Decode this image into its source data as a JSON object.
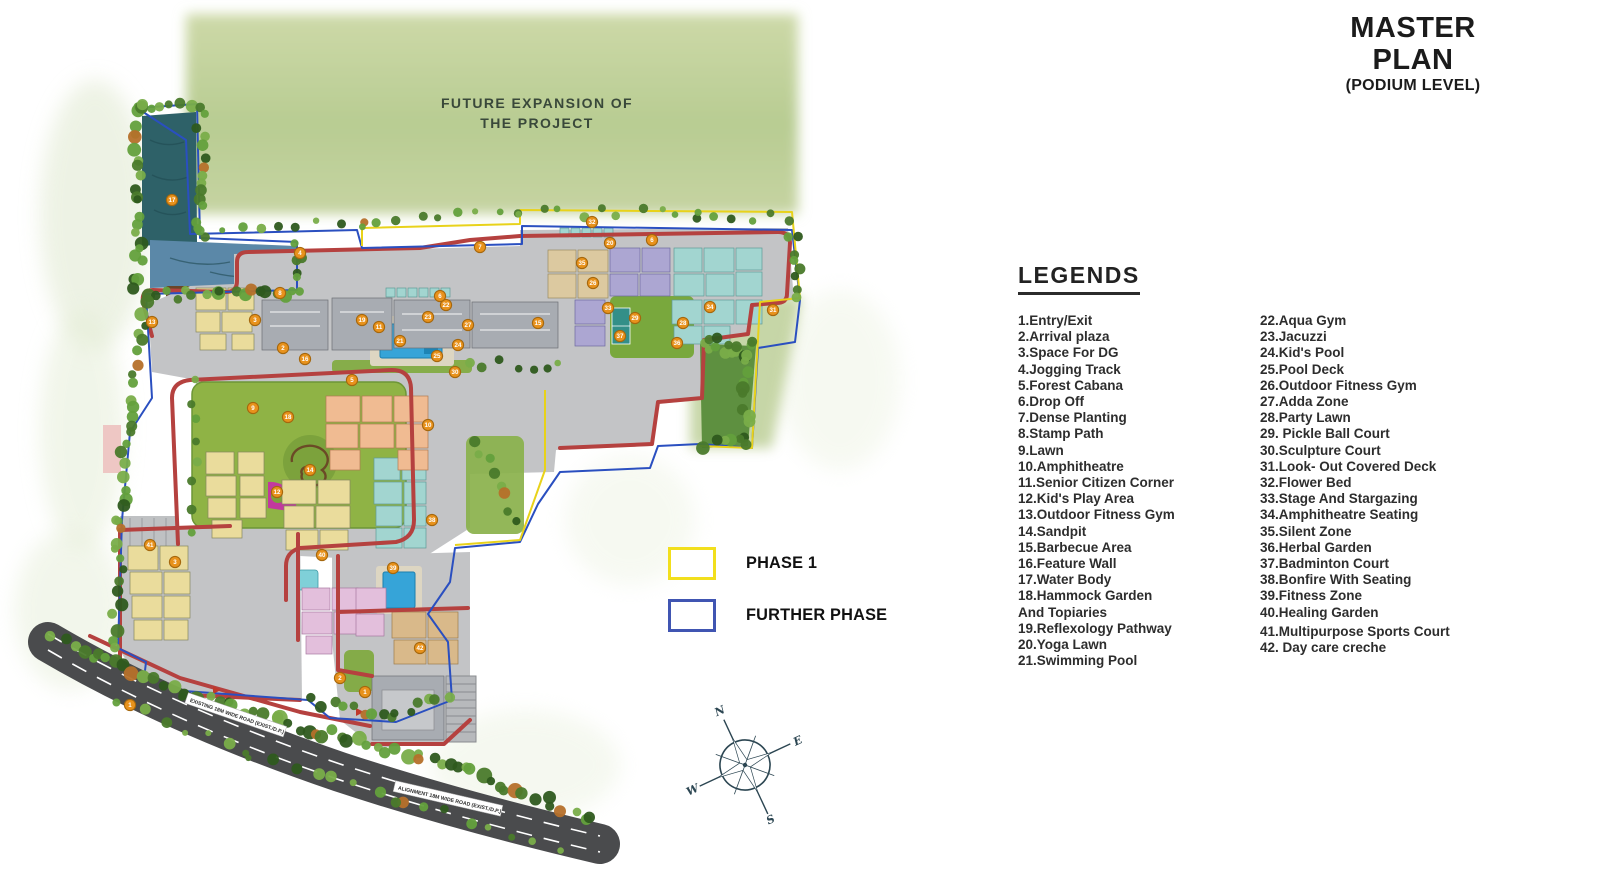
{
  "title": {
    "line1": "MASTER PLAN",
    "line2": "(PODIUM LEVEL)"
  },
  "map": {
    "future_expansion_line1": "FUTURE EXPANSION OF",
    "future_expansion_line2": "THE PROJECT",
    "road_label_1": "EXISTING 18M WIDE ROAD (EXIST./D.P.)",
    "road_label_2": "ALIGNMENT 18M WIDE ROAD (EXIST./D.P.)",
    "markers": [
      {
        "n": "17",
        "x": 172,
        "y": 200
      },
      {
        "n": "13",
        "x": 152,
        "y": 322
      },
      {
        "n": "8",
        "x": 280,
        "y": 293
      },
      {
        "n": "4",
        "x": 300,
        "y": 253
      },
      {
        "n": "7",
        "x": 480,
        "y": 247
      },
      {
        "n": "32",
        "x": 592,
        "y": 222
      },
      {
        "n": "6",
        "x": 652,
        "y": 240
      },
      {
        "n": "20",
        "x": 610,
        "y": 243
      },
      {
        "n": "35",
        "x": 582,
        "y": 263
      },
      {
        "n": "26",
        "x": 593,
        "y": 283
      },
      {
        "n": "36",
        "x": 677,
        "y": 343
      },
      {
        "n": "34",
        "x": 710,
        "y": 307
      },
      {
        "n": "31",
        "x": 773,
        "y": 310
      },
      {
        "n": "28",
        "x": 683,
        "y": 323
      },
      {
        "n": "29",
        "x": 635,
        "y": 318
      },
      {
        "n": "37",
        "x": 620,
        "y": 336
      },
      {
        "n": "33",
        "x": 608,
        "y": 308
      },
      {
        "n": "3",
        "x": 255,
        "y": 320
      },
      {
        "n": "2",
        "x": 283,
        "y": 348
      },
      {
        "n": "16",
        "x": 305,
        "y": 359
      },
      {
        "n": "19",
        "x": 362,
        "y": 320
      },
      {
        "n": "11",
        "x": 379,
        "y": 327
      },
      {
        "n": "21",
        "x": 400,
        "y": 341
      },
      {
        "n": "23",
        "x": 428,
        "y": 317
      },
      {
        "n": "22",
        "x": 446,
        "y": 305
      },
      {
        "n": "24",
        "x": 458,
        "y": 345
      },
      {
        "n": "25",
        "x": 437,
        "y": 356
      },
      {
        "n": "27",
        "x": 468,
        "y": 325
      },
      {
        "n": "9",
        "x": 253,
        "y": 408
      },
      {
        "n": "18",
        "x": 288,
        "y": 417
      },
      {
        "n": "10",
        "x": 428,
        "y": 425
      },
      {
        "n": "30",
        "x": 455,
        "y": 372
      },
      {
        "n": "15",
        "x": 538,
        "y": 323
      },
      {
        "n": "12",
        "x": 277,
        "y": 492
      },
      {
        "n": "14",
        "x": 310,
        "y": 470
      },
      {
        "n": "5",
        "x": 352,
        "y": 380
      },
      {
        "n": "38",
        "x": 432,
        "y": 520
      },
      {
        "n": "39",
        "x": 393,
        "y": 568
      },
      {
        "n": "40",
        "x": 322,
        "y": 555
      },
      {
        "n": "41",
        "x": 150,
        "y": 545
      },
      {
        "n": "42",
        "x": 420,
        "y": 648
      },
      {
        "n": "1",
        "x": 130,
        "y": 705
      },
      {
        "n": "1",
        "x": 365,
        "y": 692
      },
      {
        "n": "2",
        "x": 340,
        "y": 678
      },
      {
        "n": "3",
        "x": 175,
        "y": 562
      },
      {
        "n": "6",
        "x": 440,
        "y": 296
      }
    ]
  },
  "phase_legend": {
    "items": [
      {
        "label": "PHASE 1",
        "color": "#f2df1d"
      },
      {
        "label": "FURTHER PHASE",
        "color": "#4055b2"
      }
    ]
  },
  "compass": {
    "n": "N",
    "e": "E",
    "s": "S",
    "w": "W"
  },
  "legends": {
    "heading": "LEGENDS",
    "column1": [
      "1.Entry/Exit",
      "2.Arrival plaza",
      "3.Space For DG",
      "4.Jogging Track",
      "5.Forest Cabana",
      "6.Drop Off",
      "7.Dense Planting",
      "8.Stamp Path",
      "9.Lawn",
      "10.Amphitheatre",
      "11.Senior Citizen Corner",
      "12.Kid's Play Area",
      "13.Outdoor Fitness Gym",
      "14.Sandpit",
      "15.Barbecue Area",
      "16.Feature Wall",
      "17.Water Body",
      "18.Hammock Garden\n    And Topiaries",
      "19.Reflexology Pathway",
      "20.Yoga Lawn",
      "21.Swimming Pool"
    ],
    "column2": [
      "22.Aqua Gym",
      "23.Jacuzzi",
      "24.Kid's Pool",
      "25.Pool Deck",
      "26.Outdoor Fitness Gym",
      "27.Adda Zone",
      "28.Party Lawn",
      "29. Pickle Ball Court",
      "30.Sculpture Court",
      "31.Look- Out Covered Deck",
      "32.Flower Bed",
      "33.Stage And Stargazing",
      "34.Amphitheatre Seating",
      "35.Silent Zone",
      "36.Herbal Garden",
      "37.Badminton Court",
      "38.Bonfire With Seating",
      "39.Fitness Zone",
      "40.Healing Garden",
      "41.Multipurpose Sports Court",
      "42. Day care creche"
    ]
  },
  "colors": {
    "track_red": "#b5413f",
    "boundary_blue": "#2a4fc0",
    "boundary_yellow": "#e8d21a",
    "water": "#2e6168",
    "pool": "#36a4d8",
    "lawn": "#8fb345",
    "marker": "#e8921c",
    "road": "#4a4b4d"
  }
}
